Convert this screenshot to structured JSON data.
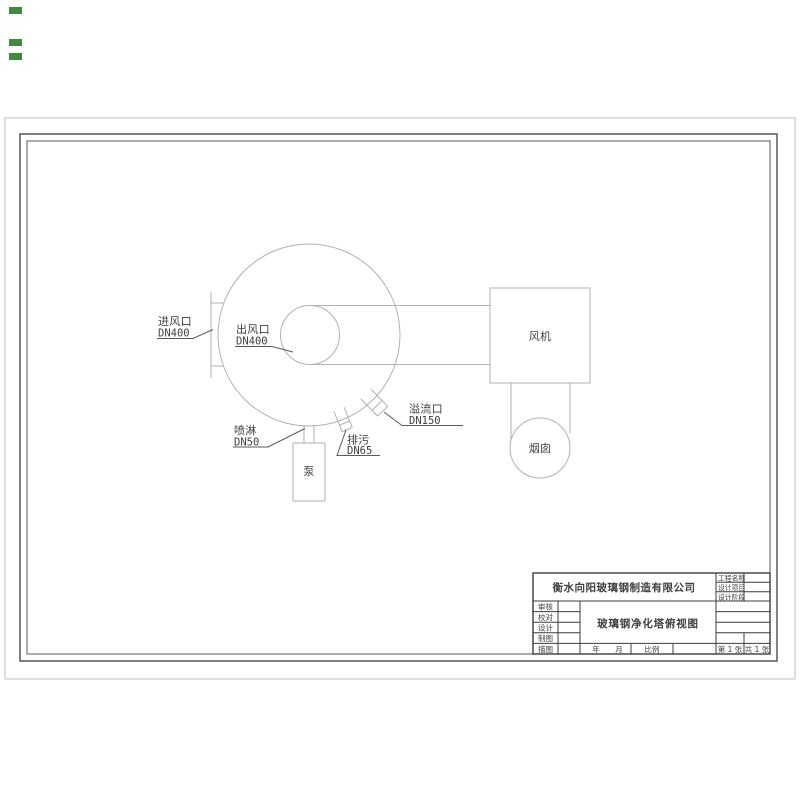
{
  "drawing": {
    "labels": {
      "inlet": {
        "name": "进风口",
        "dn": "DN400"
      },
      "outlet": {
        "name": "出风口",
        "dn": "DN400"
      },
      "overflow": {
        "name": "溢流口",
        "dn": "DN150"
      },
      "drain": {
        "name": "排污",
        "dn": "DN65"
      },
      "spray": {
        "name": "喷淋",
        "dn": "DN50"
      },
      "pump": "泵",
      "fan": "风机",
      "chimney": "烟囱"
    }
  },
  "title_block": {
    "company": "衡水向阳玻璃钢制造有限公司",
    "drawing_title": "玻璃钢净化塔俯视图",
    "project_fields": [
      "工程名称",
      "设计项目",
      "设计阶段"
    ],
    "role_fields": [
      "审核",
      "校对",
      "设计",
      "制图",
      "描图"
    ],
    "year_label": "年",
    "month_label": "月",
    "scale_label": "比例",
    "sheet_no": "第 1 张",
    "sheet_total": "共 1 张"
  },
  "colors": {
    "geometry_line": "#b2b2b2",
    "leader_line": "#5a5a5a",
    "frame_line": "#4a4a4a",
    "text": "#3f3f3f",
    "corner_marks": "#3e8a3e"
  }
}
